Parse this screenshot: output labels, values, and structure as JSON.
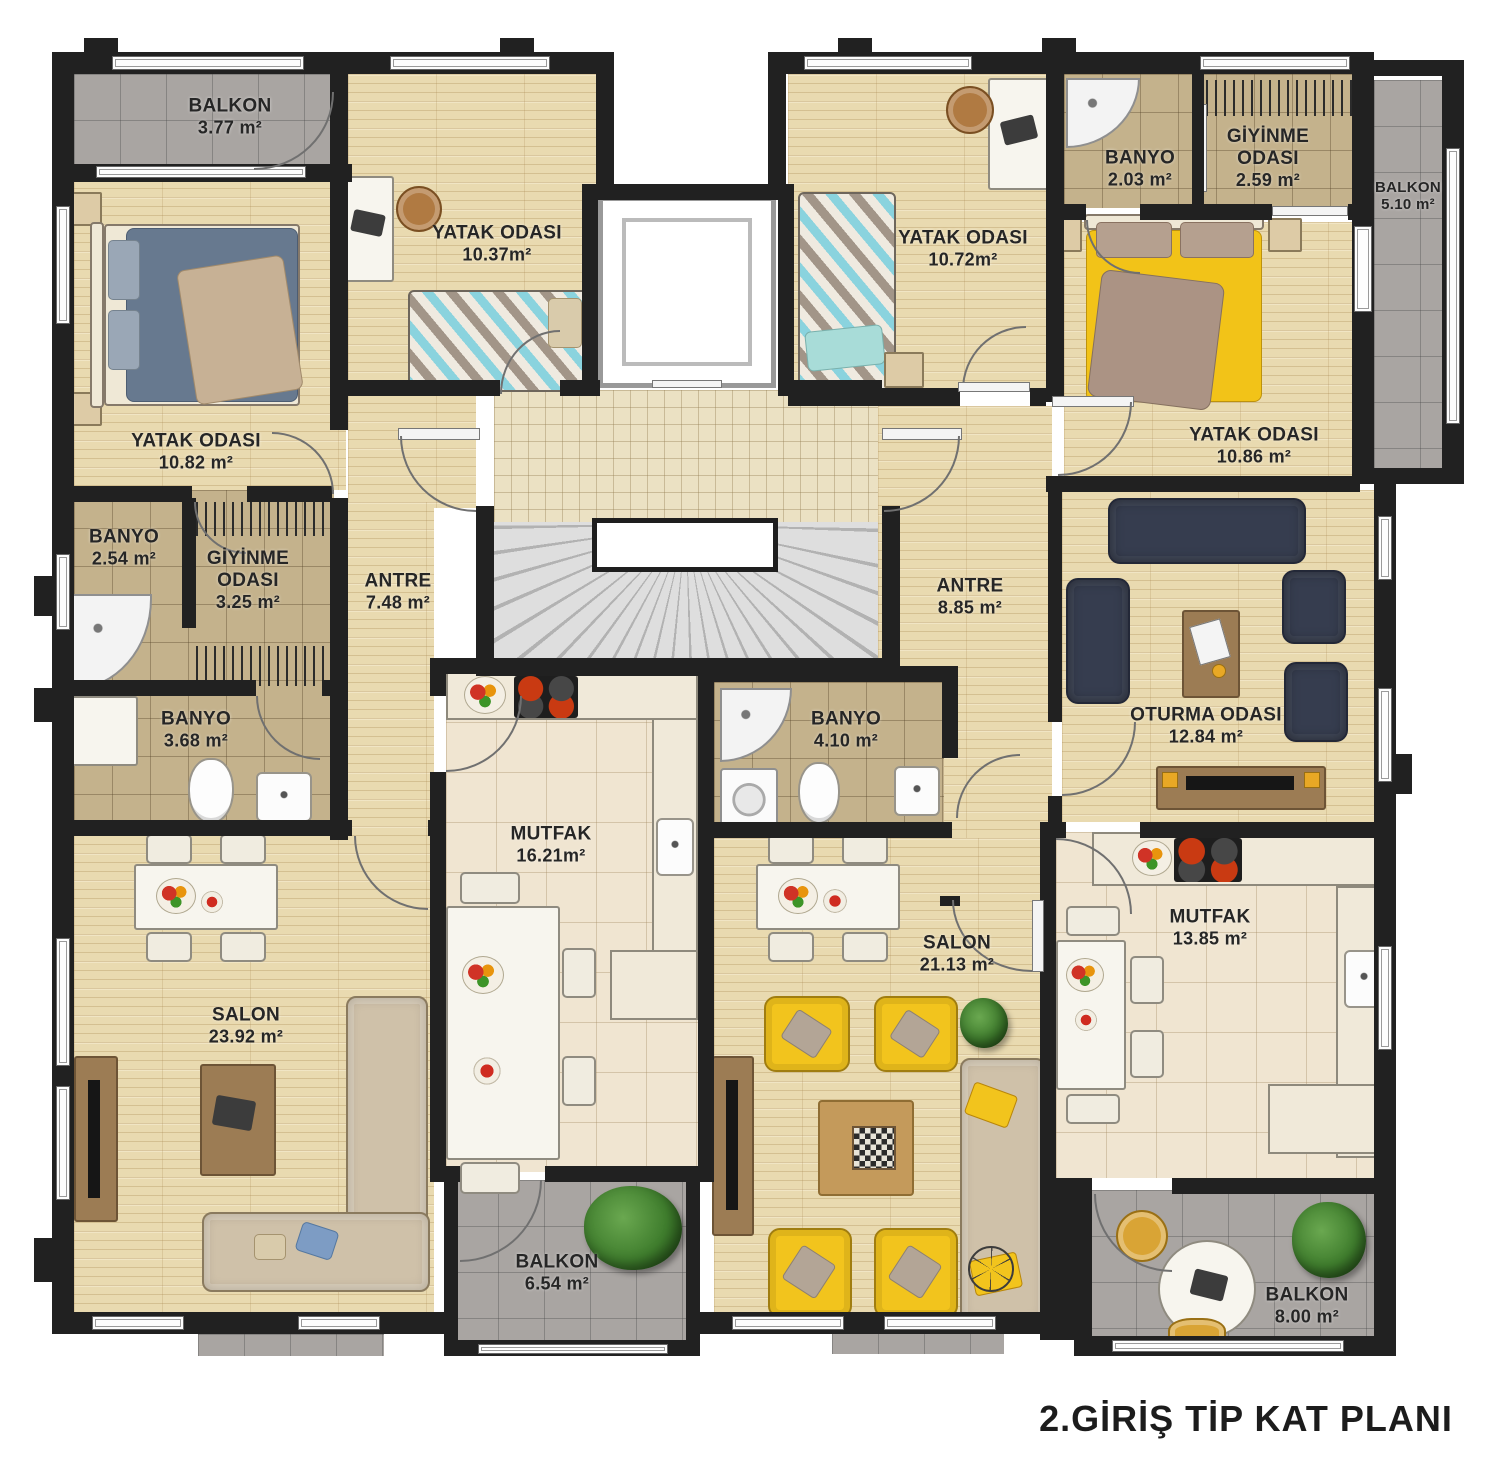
{
  "title": "2.GİRİŞ TİP KAT PLANI",
  "plan_type": "apartment-typical-floor-plan",
  "colors": {
    "wall": "#212121",
    "wood_floor": "#e9dab0",
    "bath_tile": "#c4b28c",
    "balcony_tile": "#a9a5a2",
    "kitchen_tile": "#f0e5d1",
    "accent_yellow": "#f2c41d",
    "sofa_navy": "#363d4f"
  },
  "rooms": {
    "balkon_tl": {
      "name": "BALKON",
      "area": "3.77 m²"
    },
    "yatak_a1": {
      "name": "YATAK ODASI",
      "area": "10.82 m²"
    },
    "yatak_a2": {
      "name": "YATAK ODASI",
      "area": "10.37m²"
    },
    "banyo_a1": {
      "name": "BANYO",
      "area": "2.54 m²"
    },
    "giyinme_a": {
      "name": "GİYİNME ODASI",
      "area": "3.25 m²"
    },
    "antre_a": {
      "name": "ANTRE",
      "area": "7.48 m²"
    },
    "banyo_a2": {
      "name": "BANYO",
      "area": "3.68 m²"
    },
    "mutfak_a": {
      "name": "MUTFAK",
      "area": "16.21m²"
    },
    "salon_a": {
      "name": "SALON",
      "area": "23.92 m²"
    },
    "balkon_a2": {
      "name": "BALKON",
      "area": "6.54 m²"
    },
    "yatak_b1": {
      "name": "YATAK ODASI",
      "area": "10.72m²"
    },
    "banyo_b1": {
      "name": "BANYO",
      "area": "2.03 m²"
    },
    "giyinme_b": {
      "name": "GİYİNME ODASI",
      "area": "2.59 m²"
    },
    "balkon_b1": {
      "name": "BALKON",
      "area": "5.10 m²"
    },
    "yatak_b2": {
      "name": "YATAK ODASI",
      "area": "10.86 m²"
    },
    "antre_b": {
      "name": "ANTRE",
      "area": "8.85 m²"
    },
    "oturma_b": {
      "name": "OTURMA ODASI",
      "area": "12.84 m²"
    },
    "banyo_b2": {
      "name": "BANYO",
      "area": "4.10 m²"
    },
    "salon_b": {
      "name": "SALON",
      "area": "21.13 m²"
    },
    "mutfak_b": {
      "name": "MUTFAK",
      "area": "13.85 m²"
    },
    "balkon_b2": {
      "name": "BALKON",
      "area": "8.00 m²"
    }
  }
}
